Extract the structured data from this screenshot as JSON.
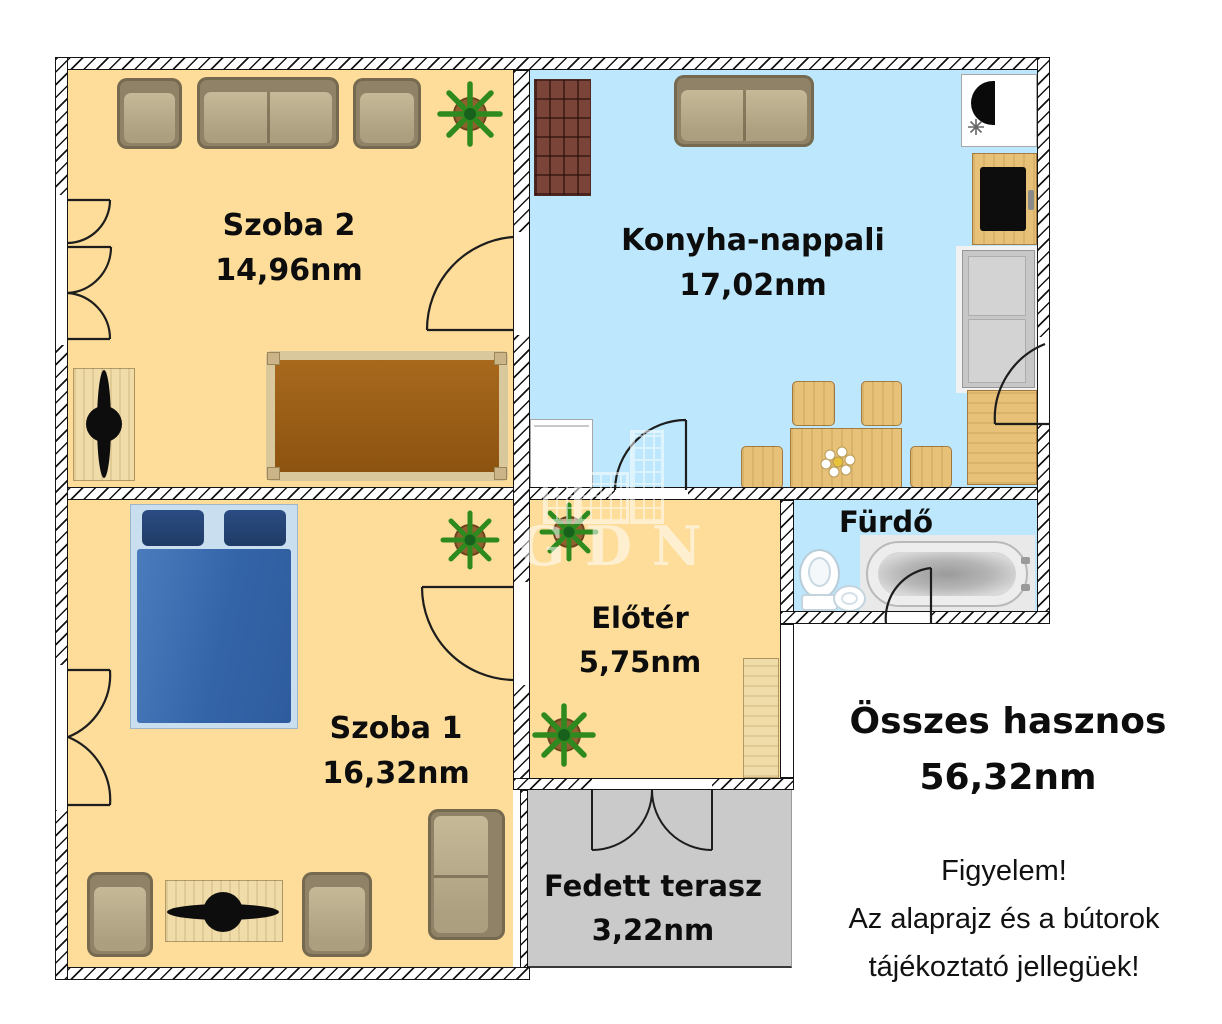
{
  "watermark": {
    "text": "GDN"
  },
  "rooms": [
    {
      "name": "Szoba 2",
      "area": "14,96nm"
    },
    {
      "name": "Konyha-nappali",
      "area": "17,02nm"
    },
    {
      "name": "Szoba 1",
      "area": "16,32nm"
    },
    {
      "name": "Előtér",
      "area": "5,75nm"
    },
    {
      "name": "Fürdő",
      "area": ""
    },
    {
      "name": "Fedett terasz",
      "area": "3,22nm"
    }
  ],
  "summary": {
    "label": "Összes hasznos",
    "value": "56,32nm"
  },
  "disclaimer": {
    "lines": [
      "Figyelem!",
      "Az alaprajz és a bútorok",
      "tájékoztató jellegüek!"
    ]
  },
  "colors": {
    "room_warm": "#FDDD99",
    "room_cool": "#BCE7FC",
    "terrace_gray": "#CACACA",
    "wall_line": "#151515",
    "bed_blue": "#3464A8",
    "wood": "#E7C177"
  },
  "icons": {
    "plant": "plant-icon",
    "door": "door-arc",
    "bathtub": "bathtub-icon",
    "toilet": "toilet-icon"
  }
}
